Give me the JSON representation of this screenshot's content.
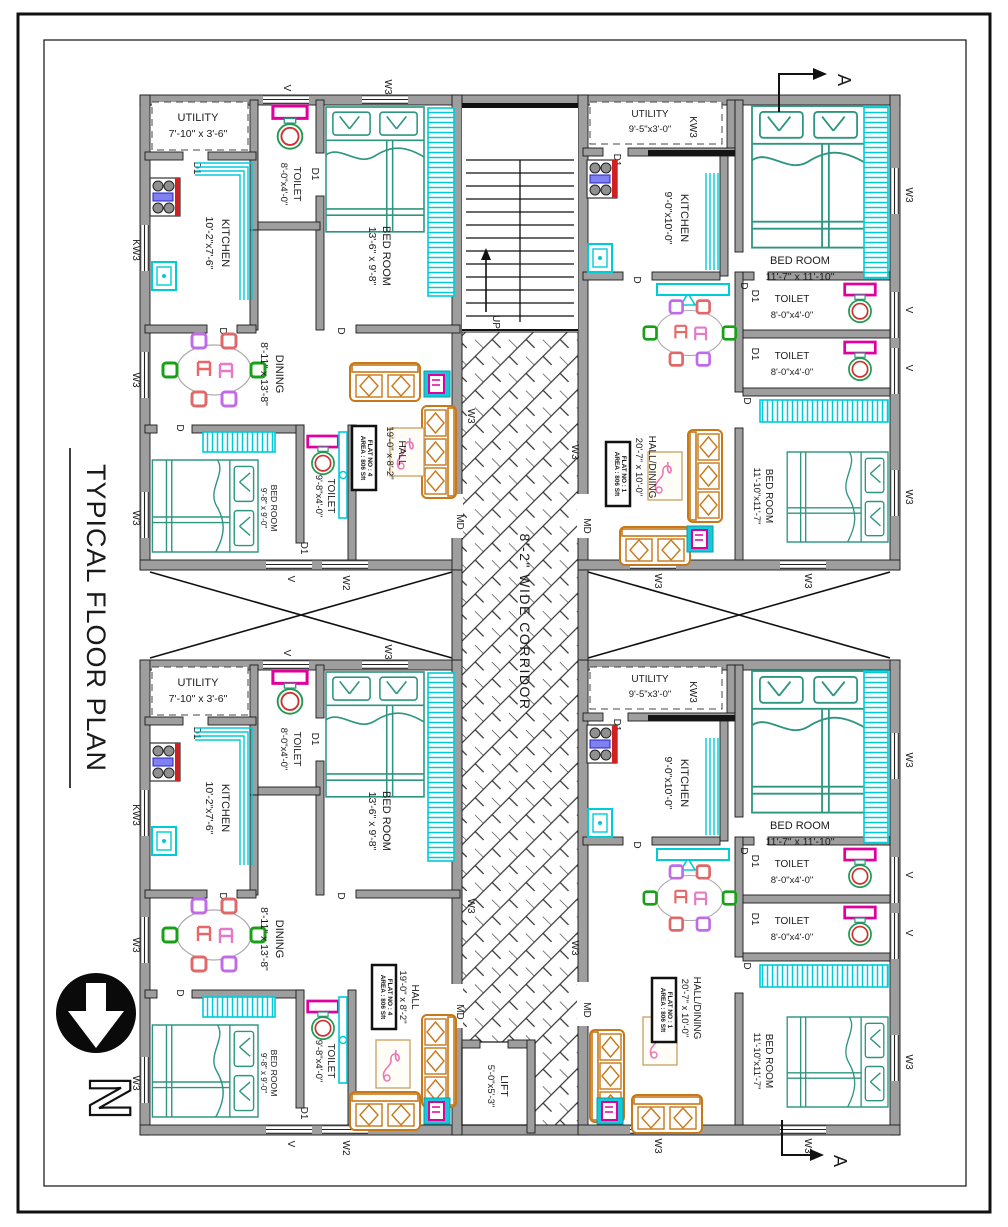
{
  "title": "TYPICAL FLOOR PLAN",
  "north_label": "N",
  "section_label": "A",
  "corridor": {
    "label": "8'-2\" WIDE CORRIDOR",
    "up": "UP",
    "lift_name": "LIFT",
    "lift_dims": "5'-0\"x5'-3\""
  },
  "tags": {
    "d": "D",
    "d1": "D1",
    "md": "MD",
    "v": "V",
    "w2": "W2",
    "w3": "W3",
    "kw3": "KW3"
  },
  "flat_left": {
    "utility": {
      "name": "UTILITY",
      "dims": "7'-10\" x 3'-6\""
    },
    "kitchen": {
      "name": "KITCHEN",
      "dims": "10'-2\"x7'-6\""
    },
    "toilet1": {
      "name": "TOILET",
      "dims": "8'-0\"x4'-0\""
    },
    "bedroom1": {
      "name": "BED ROOM",
      "dims": "13'-6\" x 9'-8\""
    },
    "dining": {
      "name": "DINING",
      "dims": "8'-11\" x 13'-8\""
    },
    "bedroom2": {
      "name": "BED ROOM",
      "dims": "9'-8\" x 9'-0\""
    },
    "toilet2": {
      "name": "TOILET",
      "dims": "9'-8\"x4'-0\""
    },
    "hall": {
      "name": "HALL",
      "dims": "19'-0\" x 8'-2\""
    },
    "flat_no": "FLAT NO : 4",
    "area": "AREA : 806 Sft"
  },
  "flat_right": {
    "utility": {
      "name": "UTILITY",
      "dims": "9'-5\"x3'-0\""
    },
    "kitchen": {
      "name": "KITCHEN",
      "dims": "9'-0\"x10'-0\""
    },
    "bedroom1": {
      "name": "BED ROOM",
      "dims": "11'-7\" x 11'-10\""
    },
    "toilet1": {
      "name": "TOILET",
      "dims": "8'-0\"x4'-0\""
    },
    "toilet2": {
      "name": "TOILET",
      "dims": "8'-0\"x4'-0\""
    },
    "bedroom2": {
      "name": "BED ROOM",
      "dims": "11'-10\"x11'-7\""
    },
    "hall": {
      "name": "HALL/DINING",
      "dims": "20'-7\" x 10'-0\""
    },
    "flat_no": "FLAT NO : 1",
    "area": "AREA : 806 Sft"
  },
  "colors": {
    "wall": "#9e9e9e",
    "cyan": "#00ccd8",
    "teal": "#2e9680",
    "orange": "#c87818",
    "magenta": "#e0009e",
    "chair_green": "#18a018",
    "chair_red": "#e06868",
    "chair_violet": "#c06ce8",
    "ink": "#1a1a1a"
  }
}
